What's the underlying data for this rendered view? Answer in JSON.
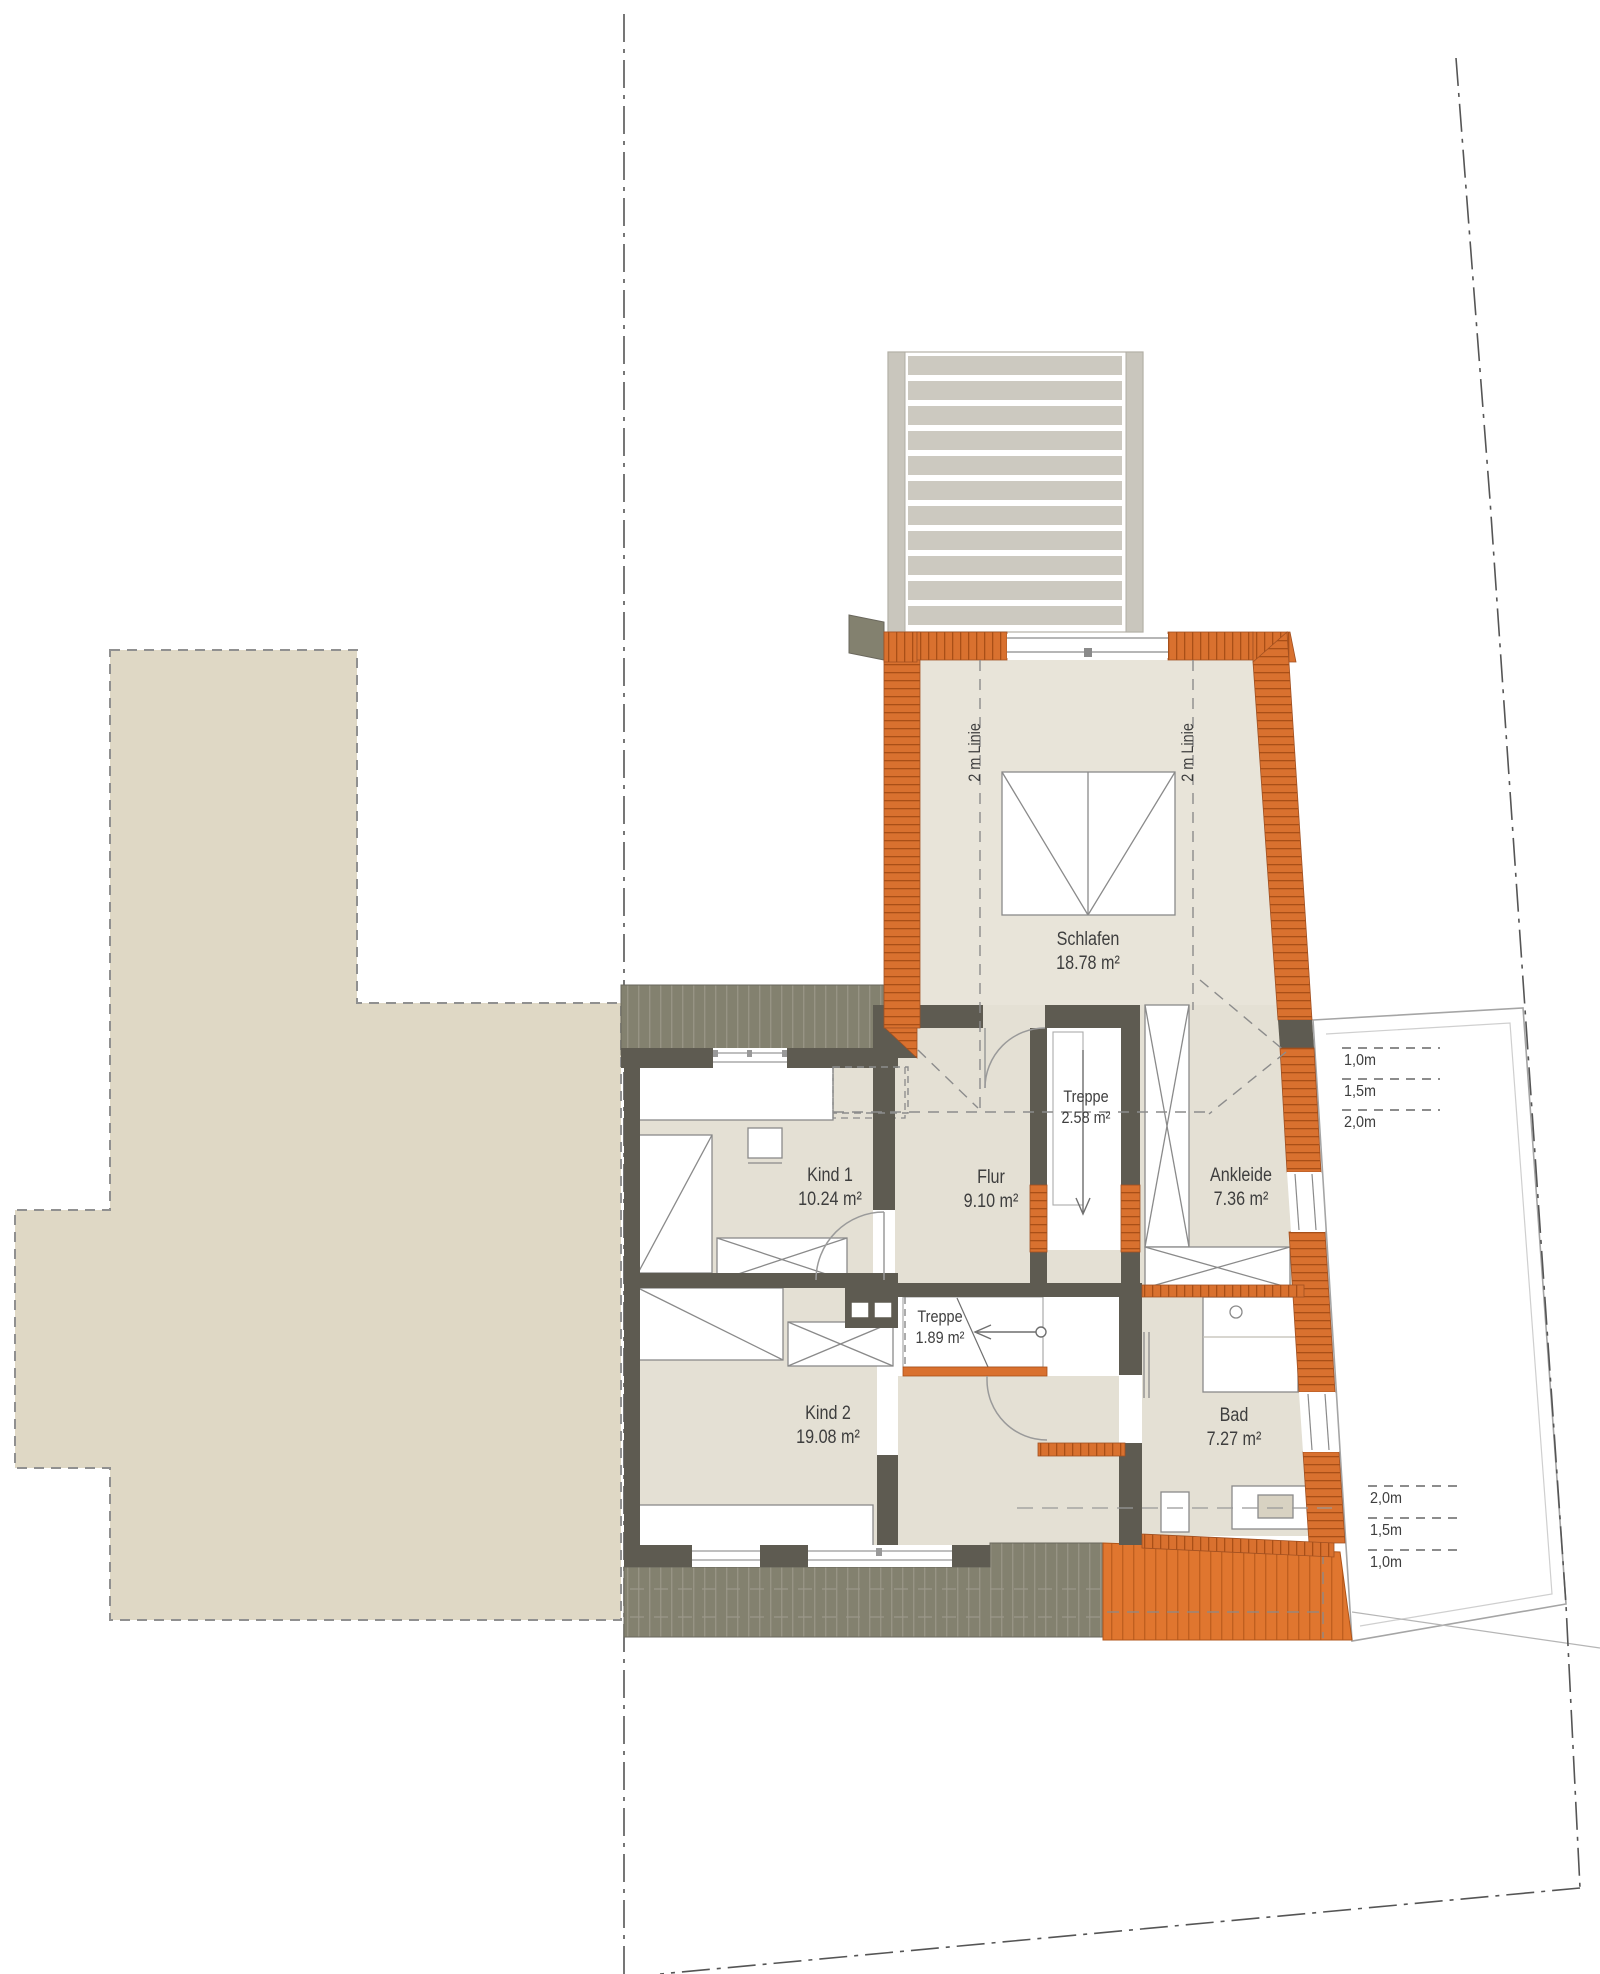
{
  "plan": {
    "type": "floor-plan-upper-storey",
    "rooms": {
      "schlafen": {
        "name": "Schlafen",
        "area": "18.78 m²"
      },
      "kind1": {
        "name": "Kind 1",
        "area": "10.24 m²"
      },
      "flur": {
        "name": "Flur",
        "area": "9.10 m²"
      },
      "treppe_og": {
        "name": "Treppe",
        "area": "2.58 m²"
      },
      "ankleide": {
        "name": "Ankleide",
        "area": "7.36 m²"
      },
      "kind2": {
        "name": "Kind 2",
        "area": "19.08 m²"
      },
      "treppe_dg": {
        "name": "Treppe",
        "area": "1.89 m²"
      },
      "bad": {
        "name": "Bad",
        "area": "7.27 m²"
      }
    },
    "annotations": {
      "roof_line_left": "2 m Linie",
      "roof_line_right": "2 m Linie",
      "height_marks_upper": [
        "1,0m",
        "1,5m",
        "2,0m"
      ],
      "height_marks_lower": [
        "2,0m",
        "1,5m",
        "1,0m"
      ]
    },
    "colors": {
      "brick_wall": "#d9712f",
      "brick_joint": "#a94f17",
      "interior_wall": "#5e5b51",
      "floor": "#e6e2d6",
      "neighbor_building": "#dfd8c5",
      "roof_deck_hatch": "#83816f",
      "orange_roof_hatch": "#e0762f",
      "deck_slats": "#ccc9c0",
      "line_text": "#3e3e3e"
    }
  }
}
